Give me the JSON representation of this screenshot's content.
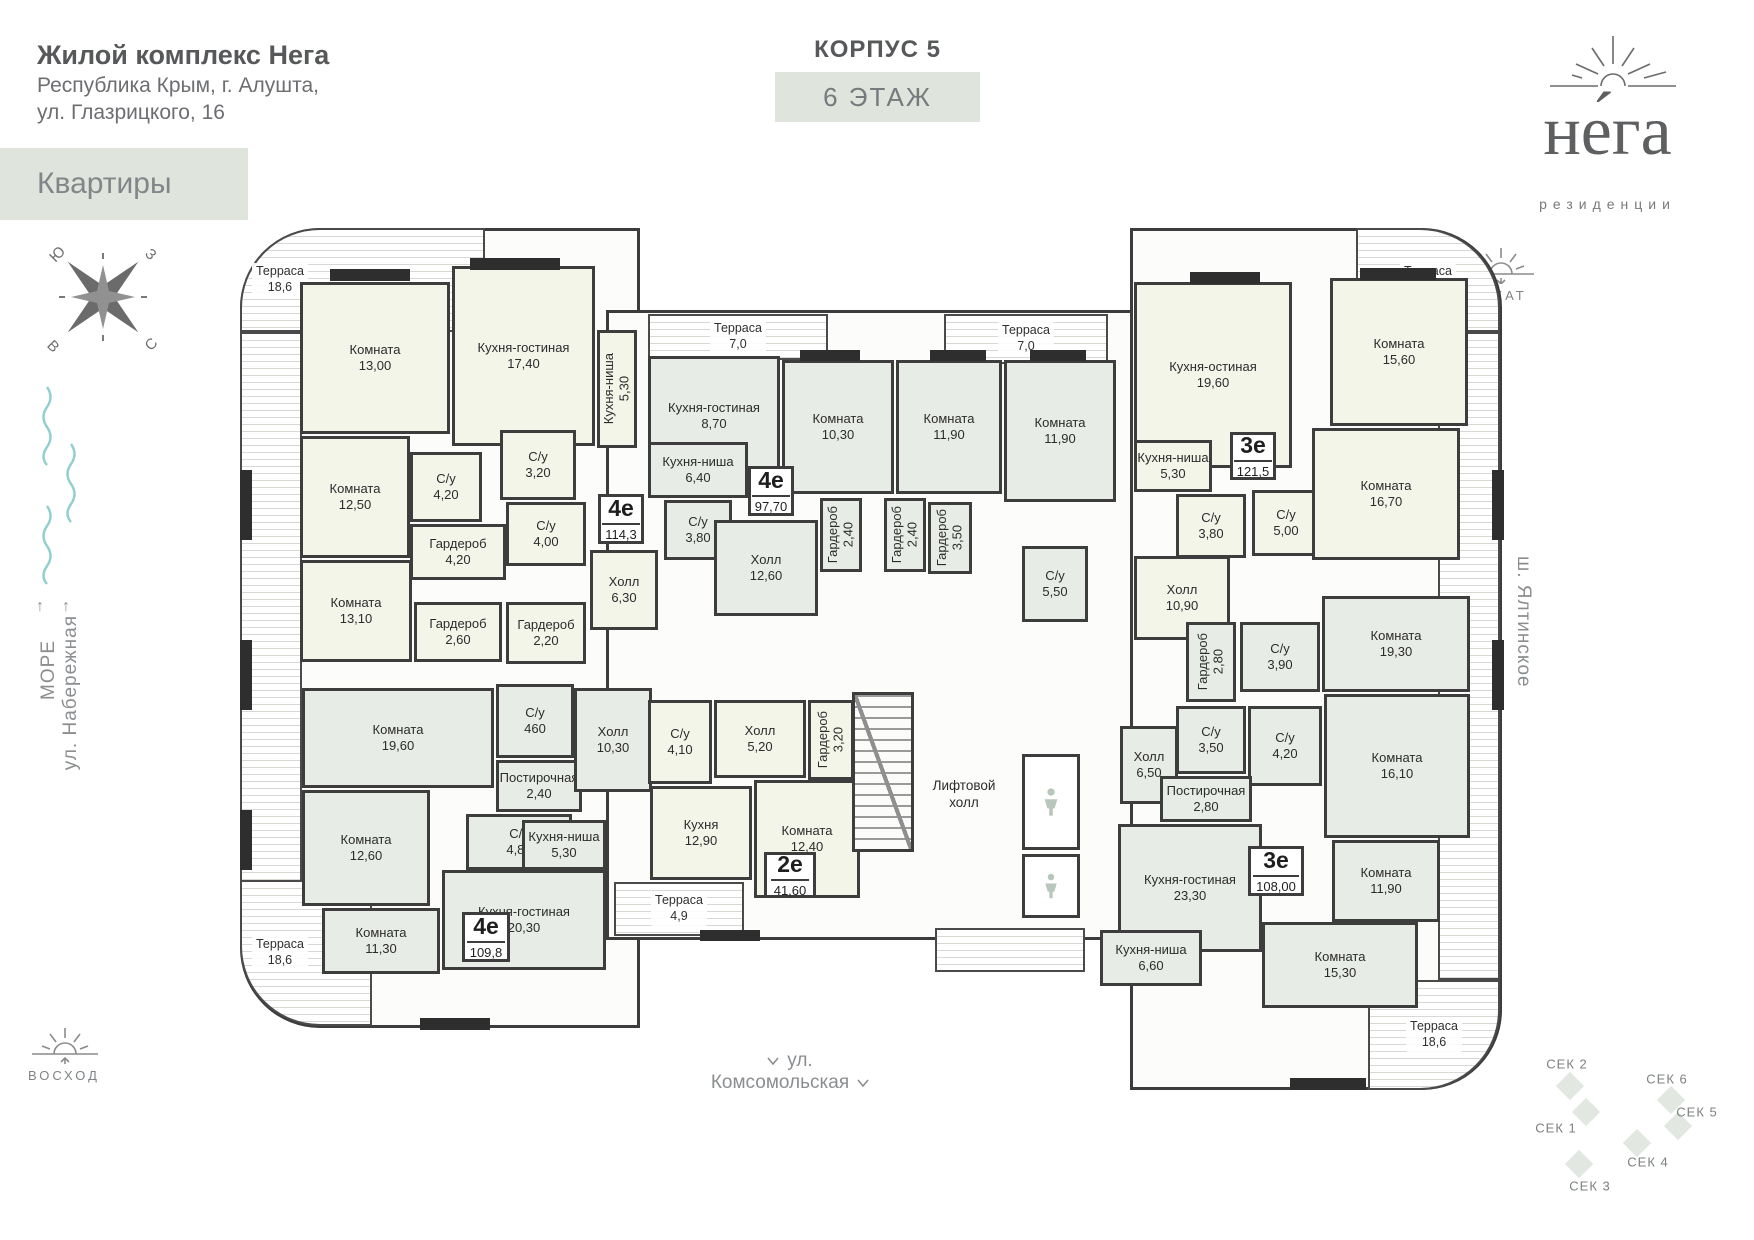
{
  "header": {
    "title": "Жилой комплекс Нега",
    "address_line1": "Республика Крым, г. Алушта,",
    "address_line2": "ул. Глазрицкого, 16",
    "apartments_button": "Квартиры",
    "korpus": "КОРПУС 5",
    "floor": "6 ЭТАЖ"
  },
  "logo": {
    "name": "не́га",
    "tagline": "резиденции"
  },
  "sides": {
    "sea": "МОРЕ",
    "embankment": "ул. Набережная",
    "yalta_highway": "ш. Ялтинское",
    "komsomolskaya": "ул. Комсомольская",
    "sunset": "ЗАКАТ",
    "sunrise": "ВОСХОД"
  },
  "compass": {
    "nw": "Ю",
    "ne": "З",
    "sw": "В",
    "se": "С"
  },
  "core": {
    "lift_hall_line1": "Лифтовой",
    "lift_hall_line2": "холл"
  },
  "apartments": [
    {
      "type": "4е",
      "area": "114,3",
      "x": 598,
      "y": 494,
      "w": 46,
      "h": 50
    },
    {
      "type": "4е",
      "area": "97,70",
      "x": 748,
      "y": 466,
      "w": 46,
      "h": 50
    },
    {
      "type": "3е",
      "area": "121,5",
      "x": 1230,
      "y": 432,
      "w": 46,
      "h": 48
    },
    {
      "type": "4е",
      "area": "109,8",
      "x": 462,
      "y": 912,
      "w": 48,
      "h": 50
    },
    {
      "type": "2е",
      "area": "41,60",
      "x": 764,
      "y": 852,
      "w": 52,
      "h": 46
    },
    {
      "type": "3е",
      "area": "108,00",
      "x": 1248,
      "y": 846,
      "w": 56,
      "h": 50
    }
  ],
  "rooms": [
    {
      "n": "Комната",
      "a": "13,00",
      "x": 300,
      "y": 282,
      "w": 150,
      "h": 152,
      "f": "a"
    },
    {
      "n": "Кухня-гостиная",
      "a": "17,40",
      "x": 452,
      "y": 266,
      "w": 143,
      "h": 180,
      "f": "a"
    },
    {
      "n": "Кухня-ниша",
      "a": "5,30",
      "x": 597,
      "y": 330,
      "w": 40,
      "h": 118,
      "f": "a",
      "v": true
    },
    {
      "n": "С/у",
      "a": "4,20",
      "x": 410,
      "y": 452,
      "w": 72,
      "h": 70,
      "f": "a"
    },
    {
      "n": "С/у",
      "a": "3,20",
      "x": 500,
      "y": 430,
      "w": 76,
      "h": 70,
      "f": "a"
    },
    {
      "n": "Комната",
      "a": "12,50",
      "x": 300,
      "y": 436,
      "w": 110,
      "h": 122,
      "f": "a"
    },
    {
      "n": "Гардероб",
      "a": "4,20",
      "x": 410,
      "y": 524,
      "w": 96,
      "h": 56,
      "f": "a"
    },
    {
      "n": "С/у",
      "a": "4,00",
      "x": 506,
      "y": 502,
      "w": 80,
      "h": 64,
      "f": "a"
    },
    {
      "n": "Холл",
      "a": "6,30",
      "x": 590,
      "y": 550,
      "w": 68,
      "h": 80,
      "f": "a"
    },
    {
      "n": "Комната",
      "a": "13,10",
      "x": 300,
      "y": 560,
      "w": 112,
      "h": 102,
      "f": "a"
    },
    {
      "n": "Гардероб",
      "a": "2,60",
      "x": 414,
      "y": 602,
      "w": 88,
      "h": 60,
      "f": "a"
    },
    {
      "n": "Гардероб",
      "a": "2,20",
      "x": 506,
      "y": 602,
      "w": 80,
      "h": 62,
      "f": "a"
    },
    {
      "n": "Кухня-гостиная",
      "a": "8,70",
      "x": 648,
      "y": 356,
      "w": 132,
      "h": 120,
      "f": "b"
    },
    {
      "n": "Кухня-ниша",
      "a": "6,40",
      "x": 648,
      "y": 442,
      "w": 100,
      "h": 56,
      "f": "b"
    },
    {
      "n": "С/у",
      "a": "3,80",
      "x": 664,
      "y": 500,
      "w": 68,
      "h": 60,
      "f": "b"
    },
    {
      "n": "Холл",
      "a": "12,60",
      "x": 714,
      "y": 520,
      "w": 104,
      "h": 96,
      "f": "b"
    },
    {
      "n": "Комната",
      "a": "10,30",
      "x": 782,
      "y": 360,
      "w": 112,
      "h": 134,
      "f": "b"
    },
    {
      "n": "Комната",
      "a": "11,90",
      "x": 896,
      "y": 360,
      "w": 106,
      "h": 134,
      "f": "b"
    },
    {
      "n": "Комната",
      "a": "11,90",
      "x": 1004,
      "y": 360,
      "w": 112,
      "h": 142,
      "f": "b"
    },
    {
      "n": "Гардероб",
      "a": "2,40",
      "x": 820,
      "y": 498,
      "w": 42,
      "h": 74,
      "f": "b",
      "v": true
    },
    {
      "n": "Гардероб",
      "a": "2,40",
      "x": 884,
      "y": 498,
      "w": 42,
      "h": 74,
      "f": "b",
      "v": true
    },
    {
      "n": "Гардероб",
      "a": "3,50",
      "x": 928,
      "y": 502,
      "w": 44,
      "h": 72,
      "f": "b",
      "v": true
    },
    {
      "n": "С/у",
      "a": "5,50",
      "x": 1022,
      "y": 546,
      "w": 66,
      "h": 76,
      "f": "b"
    },
    {
      "n": "Кухня-остиная",
      "a": "19,60",
      "x": 1134,
      "y": 282,
      "w": 158,
      "h": 186,
      "f": "a"
    },
    {
      "n": "Кухня-ниша",
      "a": "5,30",
      "x": 1134,
      "y": 440,
      "w": 78,
      "h": 52,
      "f": "a"
    },
    {
      "n": "С/у",
      "a": "3,80",
      "x": 1176,
      "y": 494,
      "w": 70,
      "h": 64,
      "f": "a"
    },
    {
      "n": "С/у",
      "a": "5,00",
      "x": 1252,
      "y": 490,
      "w": 68,
      "h": 66,
      "f": "a"
    },
    {
      "n": "Комната",
      "a": "15,60",
      "x": 1330,
      "y": 278,
      "w": 138,
      "h": 148,
      "f": "a"
    },
    {
      "n": "Комната",
      "a": "16,70",
      "x": 1312,
      "y": 428,
      "w": 148,
      "h": 132,
      "f": "a"
    },
    {
      "n": "Холл",
      "a": "10,90",
      "x": 1134,
      "y": 556,
      "w": 96,
      "h": 84,
      "f": "a"
    },
    {
      "n": "Гардероб",
      "a": "2,80",
      "x": 1186,
      "y": 622,
      "w": 50,
      "h": 80,
      "f": "b",
      "v": true
    },
    {
      "n": "С/у",
      "a": "3,90",
      "x": 1240,
      "y": 622,
      "w": 80,
      "h": 70,
      "f": "b"
    },
    {
      "n": "Комната",
      "a": "19,30",
      "x": 1322,
      "y": 596,
      "w": 148,
      "h": 96,
      "f": "b"
    },
    {
      "n": "С/у",
      "a": "3,50",
      "x": 1176,
      "y": 706,
      "w": 70,
      "h": 68,
      "f": "b"
    },
    {
      "n": "С/у",
      "a": "4,20",
      "x": 1248,
      "y": 706,
      "w": 74,
      "h": 80,
      "f": "b"
    },
    {
      "n": "Комната",
      "a": "16,10",
      "x": 1324,
      "y": 694,
      "w": 146,
      "h": 144,
      "f": "b"
    },
    {
      "n": "Холл",
      "a": "6,50",
      "x": 1120,
      "y": 726,
      "w": 58,
      "h": 78,
      "f": "b"
    },
    {
      "n": "Постирочная",
      "a": "2,80",
      "x": 1160,
      "y": 776,
      "w": 92,
      "h": 46,
      "f": "b"
    },
    {
      "n": "Кухня-гостиная",
      "a": "23,30",
      "x": 1118,
      "y": 824,
      "w": 144,
      "h": 128,
      "f": "b"
    },
    {
      "n": "Комната",
      "a": "11,90",
      "x": 1332,
      "y": 840,
      "w": 108,
      "h": 82,
      "f": "b"
    },
    {
      "n": "Кухня-ниша",
      "a": "6,60",
      "x": 1100,
      "y": 930,
      "w": 102,
      "h": 56,
      "f": "b"
    },
    {
      "n": "Комната",
      "a": "15,30",
      "x": 1262,
      "y": 922,
      "w": 156,
      "h": 86,
      "f": "b"
    },
    {
      "n": "Комната",
      "a": "19,60",
      "x": 302,
      "y": 688,
      "w": 192,
      "h": 100,
      "f": "b"
    },
    {
      "n": "С/у",
      "a": "460",
      "x": 496,
      "y": 684,
      "w": 78,
      "h": 74,
      "f": "b"
    },
    {
      "n": "Постирочная",
      "a": "2,40",
      "x": 496,
      "y": 760,
      "w": 86,
      "h": 52,
      "f": "b"
    },
    {
      "n": "С/у",
      "a": "4,80",
      "x": 466,
      "y": 814,
      "w": 106,
      "h": 56,
      "f": "b"
    },
    {
      "n": "Комната",
      "a": "12,60",
      "x": 302,
      "y": 790,
      "w": 128,
      "h": 116,
      "f": "b"
    },
    {
      "n": "Комната",
      "a": "11,30",
      "x": 322,
      "y": 908,
      "w": 118,
      "h": 66,
      "f": "b"
    },
    {
      "n": "Кухня-гостиная",
      "a": "20,30",
      "x": 442,
      "y": 870,
      "w": 164,
      "h": 100,
      "f": "b"
    },
    {
      "n": "Кухня-ниша",
      "a": "5,30",
      "x": 522,
      "y": 820,
      "w": 84,
      "h": 50,
      "f": "b"
    },
    {
      "n": "Холл",
      "a": "10,30",
      "x": 574,
      "y": 688,
      "w": 78,
      "h": 104,
      "f": "b"
    },
    {
      "n": "С/у",
      "a": "4,10",
      "x": 648,
      "y": 700,
      "w": 64,
      "h": 84,
      "f": "a"
    },
    {
      "n": "Холл",
      "a": "5,20",
      "x": 714,
      "y": 700,
      "w": 92,
      "h": 78,
      "f": "a"
    },
    {
      "n": "Гардероб",
      "a": "3,20",
      "x": 808,
      "y": 700,
      "w": 46,
      "h": 80,
      "f": "a",
      "v": true
    },
    {
      "n": "Кухня",
      "a": "12,90",
      "x": 650,
      "y": 786,
      "w": 102,
      "h": 94,
      "f": "a"
    },
    {
      "n": "Комната",
      "a": "12,40",
      "x": 754,
      "y": 780,
      "w": 106,
      "h": 118,
      "f": "a"
    }
  ],
  "terraces": [
    {
      "n": "Терраса",
      "a": "18,6",
      "x": 240,
      "y": 228,
      "w": 245,
      "h": 104,
      "r": "tl",
      "al": "left"
    },
    {
      "x": 240,
      "y": 332,
      "w": 62,
      "h": 568
    },
    {
      "n": "Терраса",
      "a": "18,6",
      "x": 240,
      "y": 880,
      "w": 132,
      "h": 146,
      "r": "bl",
      "al": "left"
    },
    {
      "n": "Терраса",
      "a": "7,0",
      "x": 648,
      "y": 314,
      "w": 180,
      "h": 46
    },
    {
      "n": "Терраса",
      "a": "7,0",
      "x": 944,
      "y": 314,
      "w": 164,
      "h": 50
    },
    {
      "n": "Терраса",
      "a": "18,6",
      "x": 1356,
      "y": 228,
      "w": 144,
      "h": 104,
      "r": "tr"
    },
    {
      "x": 1438,
      "y": 332,
      "w": 62,
      "h": 648
    },
    {
      "n": "Терраса",
      "a": "18,6",
      "x": 1368,
      "y": 980,
      "w": 132,
      "h": 110,
      "r": "br"
    },
    {
      "n": "Терраса",
      "a": "4,9",
      "x": 614,
      "y": 882,
      "w": 130,
      "h": 54
    },
    {
      "x": 935,
      "y": 928,
      "w": 150,
      "h": 44
    }
  ],
  "sections": [
    {
      "label": "СЕК 2",
      "lx": 1567,
      "ly": 1064,
      "dx": 1570,
      "dy": 1086
    },
    {
      "label": "СЕК 6",
      "lx": 1667,
      "ly": 1079,
      "dx": 1671,
      "dy": 1100
    },
    {
      "label": "СЕК 5",
      "lx": 1697,
      "ly": 1112,
      "dx": 1678,
      "dy": 1126
    },
    {
      "label": "СЕК 1",
      "lx": 1556,
      "ly": 1128,
      "dx": 1586,
      "dy": 1112
    },
    {
      "label": "СЕК 4",
      "lx": 1648,
      "ly": 1162,
      "dx": 1637,
      "dy": 1143
    },
    {
      "label": "СЕК 3",
      "lx": 1590,
      "ly": 1186,
      "dx": 1579,
      "dy": 1164
    }
  ]
}
